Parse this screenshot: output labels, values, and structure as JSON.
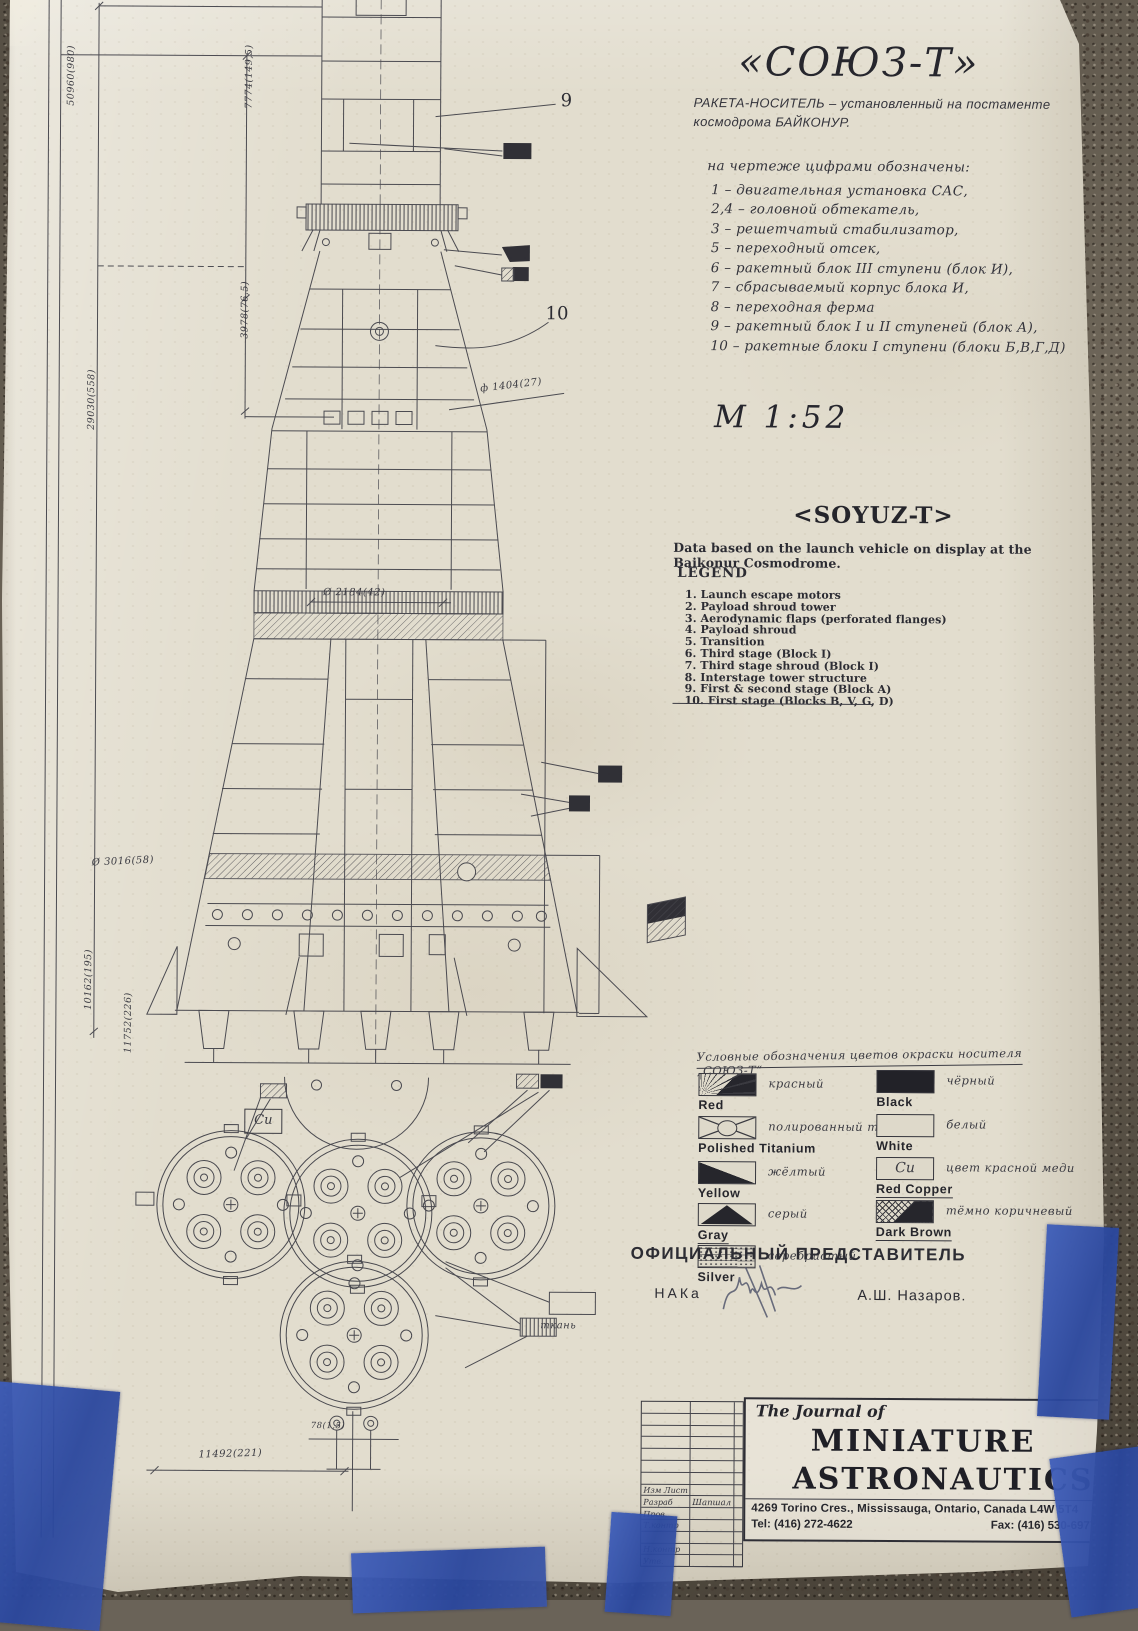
{
  "header": {
    "title_ru": "«СОЮЗ-Т»",
    "subtitle_line1": "РАКЕТА-НОСИТЕЛЬ – установленный на постаменте",
    "subtitle_line2": "космодрома   БАЙКОНУР."
  },
  "scale": "М  1:52",
  "legend_ru": {
    "header": "на чертеже цифрами обозначены:",
    "items": [
      "1 – двигательная установка САС,",
      "2,4 – головной обтекатель,",
      "3 – решетчатый стабилизатор,",
      "5 – переходный отсек,",
      "6 – ракетный блок III ступени (блок И),",
      "7 – сбрасываемый корпус блока И,",
      "8 – переходная ферма",
      "9 – ракетный блок I и II ступеней (блок А),",
      "10 – ракетные блоки I ступени (блоки Б,В,Г,Д)"
    ]
  },
  "legend_en": {
    "title": "<SOYUZ-T>",
    "note": "Data based on the launch vehicle on display at the Baikonur Cosmodrome.",
    "header": "LEGEND",
    "items": [
      "1.   Launch escape motors",
      "2.   Payload shroud tower",
      "3.   Aerodynamic flaps (perforated flanges)",
      "4.   Payload shroud",
      "5.   Transition",
      "6.   Third stage (Block I)",
      "7.   Third stage shroud (Block I)",
      "8.   Interstage tower structure",
      "9.   First & second stage (Block A)",
      "10. First stage (Blocks B, V, G, D)"
    ]
  },
  "color_legend": {
    "header": "Условные обозначения цветов окраски носителя „СОЮЗ-Т“",
    "left": [
      {
        "en": "Red",
        "ru": "красный"
      },
      {
        "en": "Polished Titanium",
        "ru": "полированный титан"
      },
      {
        "en": "Yellow",
        "ru": "жёлтый"
      },
      {
        "en": "Gray",
        "ru": "серый"
      },
      {
        "en": "Silver",
        "ru": "серебристый"
      }
    ],
    "right": [
      {
        "en": "Black",
        "ru": "чёрный"
      },
      {
        "en": "White",
        "ru": "белый"
      },
      {
        "en": "Red Copper",
        "ru": "цвет красной меди",
        "swatch_text": "Cu"
      },
      {
        "en": "Dark Brown",
        "ru": "тёмно коричневый"
      }
    ]
  },
  "official": {
    "title": "ОФИЦИАЛЬНЫЙ  ПРЕДСТАВИТЕЛЬ",
    "org": "НАКа",
    "name": "А.Ш. Назаров."
  },
  "title_block": {
    "journal_pre": "The Journal of",
    "journal_name_1": "MINIATURE",
    "journal_name_2": "ASTRONAUTICS",
    "address": "4269 Torino Cres., Mississauga, Ontario, Canada L4W 5T4",
    "tel": "Tel: (416) 272-4622",
    "fax": "Fax: (416) 530-6977",
    "rows": [
      "Изм Лист",
      "Разраб",
      "Пров.",
      "Т.контр",
      "Н.контр",
      "Утв."
    ],
    "designer": "Шапшал"
  },
  "callouts": {
    "c9": "9",
    "c10": "10"
  },
  "dims": {
    "d_total": "50960(980)",
    "d_29030": "29030(558)",
    "d_7774": "7774(149,5)",
    "d_3978": "3978(76,5)",
    "d_1404": "ф 1404(27)",
    "d_2184": "Ø 2184(42)",
    "d_3016": "Ø 3016(58)",
    "d_10162": "10162(195)",
    "d_11752": "11752(226)",
    "d_11492": "11492(221)",
    "d_78": "78(1,5)",
    "fabric": "ткань",
    "cu": "Cu"
  }
}
